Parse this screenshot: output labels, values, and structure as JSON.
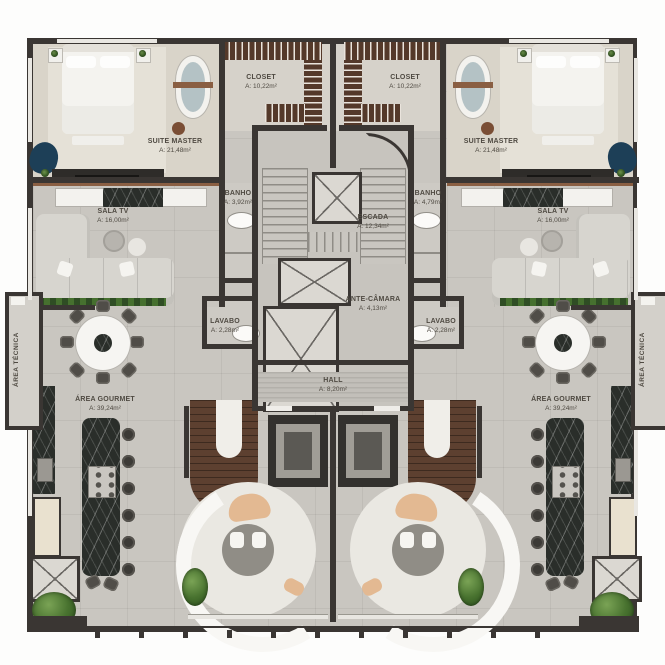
{
  "plan": {
    "type": "residential-floor-plan",
    "units": "two mirrored apartments around central stair/elevator core",
    "palette": {
      "exterior_wall": "#3a3633",
      "floor_gray": "#c9c6c0",
      "floor_beige": "#ddd7cc",
      "wood_brown": "#5d4030",
      "marble_dark": "#2a2e2a",
      "accent_navy": "#1d3f57",
      "accent_tan": "#e3b992",
      "plant_green": "#48722f",
      "label_text": "#4f4a42"
    },
    "rooms": {
      "suite_master_left": {
        "label": "SUITE MASTER",
        "area": "A: 21,48m²"
      },
      "suite_master_right": {
        "label": "SUITE MASTER",
        "area": "A: 21,48m²"
      },
      "closet_left": {
        "label": "CLOSET",
        "area": "A: 10,22m²"
      },
      "closet_right": {
        "label": "CLOSET",
        "area": "A: 10,22m²"
      },
      "banho_left": {
        "label": "BANHO",
        "area": "A: 3,92m²"
      },
      "banho_right": {
        "label": "BANHO",
        "area": "A: 4,79m²"
      },
      "escada": {
        "label": "ESCADA",
        "area": "A: 12,34m²"
      },
      "sala_tv_left": {
        "label": "SALA TV",
        "area": "A: 16,00m²"
      },
      "sala_tv_right": {
        "label": "SALA TV",
        "area": "A: 16,00m²"
      },
      "ante_camara": {
        "label": "ANTE-CÂMARA",
        "area": "A: 4,13m²"
      },
      "lavabo_left": {
        "label": "LAVABO",
        "area": "A: 2,28m²"
      },
      "lavabo_right": {
        "label": "LAVABO",
        "area": "A: 2,28m²"
      },
      "hall": {
        "label": "HALL",
        "area": "A: 8,20m²"
      },
      "area_gourmet_left": {
        "label": "ÁREA GOURMET",
        "area": "A: 39,24m²"
      },
      "area_gourmet_right": {
        "label": "ÁREA GOURMET",
        "area": "A: 39,24m²"
      },
      "area_tecnica_left": {
        "label": "ÁREA TÉCNICA"
      },
      "area_tecnica_right": {
        "label": "ÁREA TÉCNICA"
      }
    }
  }
}
